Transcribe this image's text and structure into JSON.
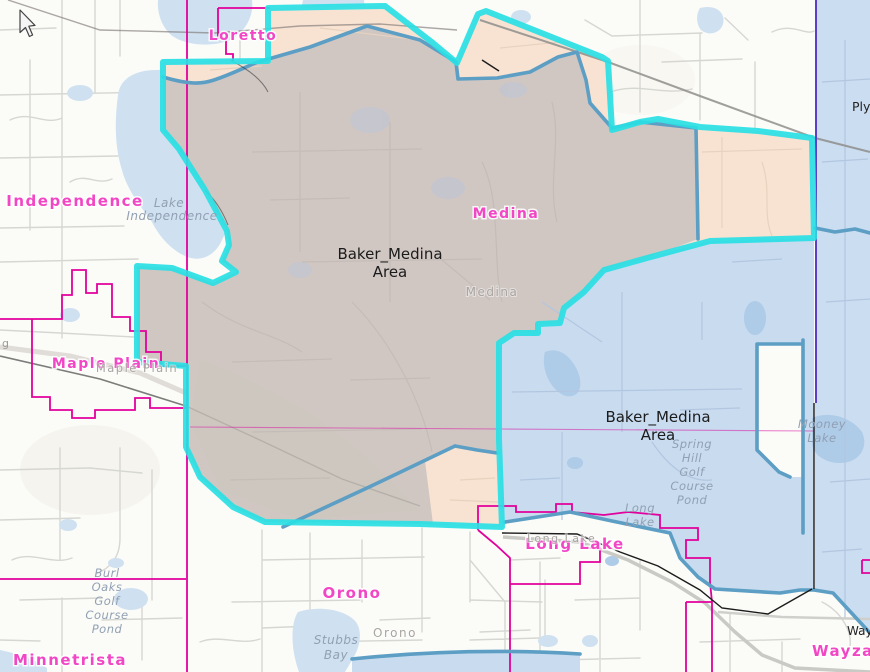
{
  "map": {
    "selection": [
      {
        "line1": "Baker_Medina",
        "line2": "Area"
      },
      {
        "line1": "Baker_Medina",
        "line2": "Area"
      }
    ],
    "cities": {
      "loretto": "Loretto",
      "independence": "Independence",
      "medina": "Medina",
      "maple_plain": "Maple Plain",
      "orono": "Orono",
      "minnetrista": "Minnetrista",
      "long_lake": "Long Lake",
      "wayzata": "Wayzata"
    },
    "towns": {
      "medina": "Medina",
      "maple_plain": "Maple Plain",
      "orono": "Orono",
      "long_lake": "Long Lake",
      "wayzata": "Wayzata",
      "plymouth": "Plymouth"
    },
    "waters": {
      "lake_independence": [
        "Lake",
        "Independence"
      ],
      "spring_hill": [
        "Spring",
        "Hill",
        "Golf",
        "Course",
        "Pond"
      ],
      "burl_oaks": [
        "Burl",
        "Oaks",
        "Golf",
        "Course",
        "Pond"
      ],
      "long_lake": [
        "Long",
        "Lake"
      ],
      "mooney": [
        "Mooney",
        "Lake"
      ],
      "stubbs": [
        "Stubbs",
        "Bay"
      ]
    },
    "road_fragment": "g",
    "colors": {
      "selection_outline_cyan": "#29e0e4",
      "district_outline_steel_blue": "#5c9ec4",
      "municipal_boundary_magenta": "#e2009c",
      "city_label_pink": "#f247c5",
      "selection_fill_taupe": "#d0c7c3",
      "district_fill_peach": "#f8e3d3",
      "district_fill_blue": "#c8dbef",
      "lake_water": "#cfe1f0",
      "county_line_purple": "#5b3fc8"
    }
  }
}
